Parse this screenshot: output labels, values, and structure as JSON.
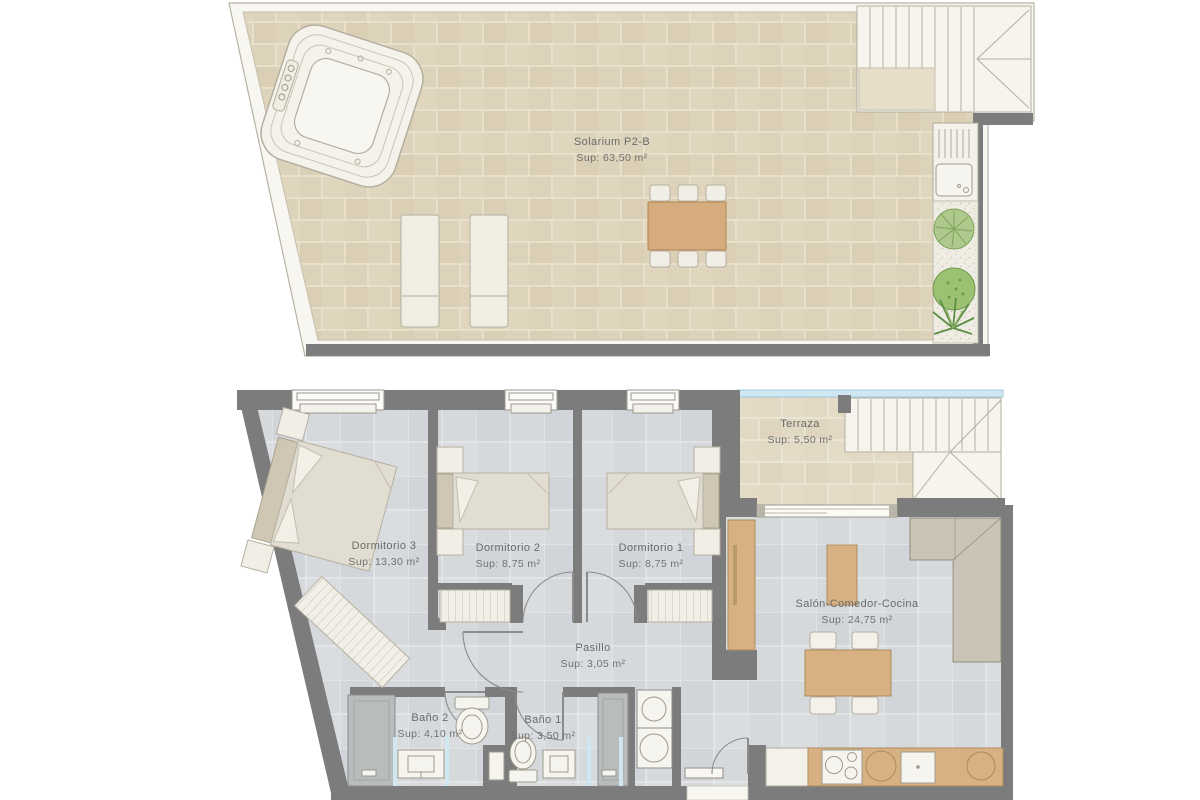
{
  "solarium": {
    "name": "Solarium P2-B",
    "sup": "Sup: 63,50 m²"
  },
  "rooms": {
    "terraza": {
      "name": "Terraza",
      "sup": "Sup: 5,50 m²"
    },
    "dormitorio3": {
      "name": "Dormitorio 3",
      "sup": "Sup: 13,30 m²"
    },
    "dormitorio2": {
      "name": "Dormitorio 2",
      "sup": "Sup: 8,75 m²"
    },
    "dormitorio1": {
      "name": "Dormitorio 1",
      "sup": "Sup: 8,75 m²"
    },
    "salon": {
      "name": "Salón-Comedor-Cocina",
      "sup": "Sup: 24,75 m²"
    },
    "pasillo": {
      "name": "Pasillo",
      "sup": "Sup: 3,05 m²"
    },
    "bano2": {
      "name": "Baño 2",
      "sup": "Sup: 4,10 m²"
    },
    "bano1": {
      "name": "Baño 1",
      "sup": "Sup: 3,50 m²"
    }
  },
  "colors": {
    "wall": "#7c7c7c",
    "solarium_tile": "#ddd3ba",
    "floor_tile": "#d6d9dc",
    "wood": "#d8b183",
    "glass": "#cfe7f0",
    "text": "#6a6a6a"
  }
}
